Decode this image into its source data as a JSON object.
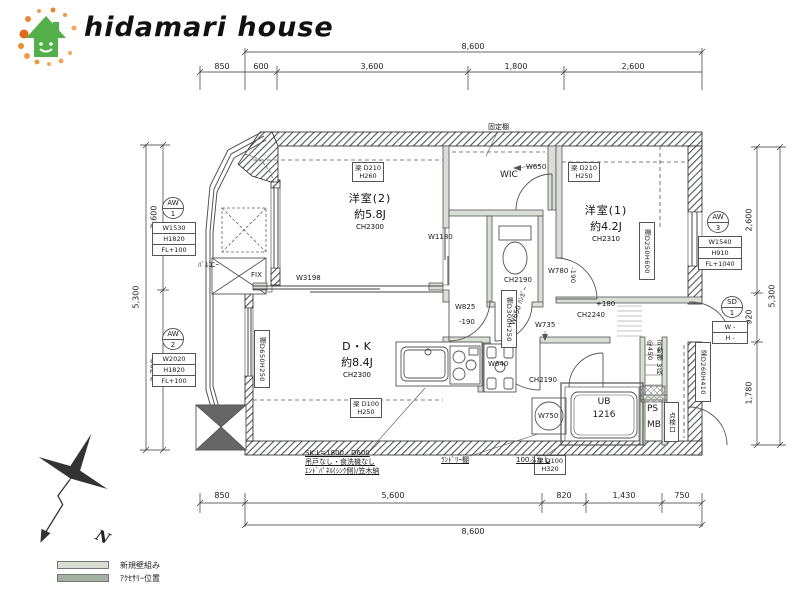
{
  "logo": {
    "text": "hidamari house"
  },
  "dims": {
    "top_total": "8,600",
    "top_segments": [
      "850",
      "600",
      "3,600",
      "1,800",
      "2,600"
    ],
    "bottom_segments": [
      "850",
      "5,600",
      "820",
      "1,430",
      "750"
    ],
    "bottom_total": "8,600",
    "left_total": "5,300",
    "left_segments": [
      "2,600",
      "2,700"
    ],
    "right_total": "5,300",
    "right_segments": [
      "2,600",
      "920",
      "1,780"
    ]
  },
  "rooms": {
    "yoshitsu2": {
      "name": "洋室(2)",
      "size": "約5.8J",
      "ch": "CH2300"
    },
    "yoshitsu1": {
      "name": "洋室(1)",
      "size": "約4.2J",
      "ch": "CH2310"
    },
    "dk": {
      "name": "D・K",
      "size": "約8.4J",
      "ch": "CH2300"
    },
    "wic": "WIC",
    "balcony": "ﾊﾞﾙｺﾆｰ",
    "ub": {
      "line1": "UB",
      "line2": "1216"
    },
    "ps": "PS",
    "mb": "MB"
  },
  "tags": {
    "aw1": {
      "type": "AW",
      "num": "1",
      "rows": [
        "W1530",
        "H1820",
        "FL+100"
      ]
    },
    "aw2": {
      "type": "AW",
      "num": "2",
      "rows": [
        "W2020",
        "H1820",
        "FL+100"
      ]
    },
    "aw3": {
      "type": "AW",
      "num": "3",
      "rows": [
        "W1540",
        "H910",
        "FL+1040"
      ]
    },
    "sd1": {
      "type": "SD",
      "num": "1",
      "rows": [
        "W -",
        "H -"
      ]
    }
  },
  "beams": {
    "y2": {
      "l1": "梁 D210",
      "l2": "H260"
    },
    "y1": {
      "l1": "梁 D210",
      "l2": "H250"
    },
    "dk": {
      "l1": "梁 D100",
      "l2": "H250"
    },
    "south": {
      "l1": "梁 D100",
      "l2": "H320"
    },
    "east": "梁D260H410"
  },
  "shelves": {
    "dk_side": "棚D650H250",
    "hall": "棚D300H250",
    "y1_side": "棚D250H600",
    "fixed": "固定棚",
    "movable": "可動棚 3段 @450",
    "laundry": "ﾗﾝﾄﾞﾘｰ棚"
  },
  "annotations": {
    "fix": "FIX",
    "w3198": "W3198",
    "w1180": "W1180",
    "w650": "W650",
    "w780": "W780",
    "m190a": "-190",
    "m190b": "-190",
    "w825": "W825",
    "w650hanger": "W650 ﾊﾝｶﾞｰ",
    "w735": "W735",
    "ch2240": "CH2240",
    "p180": "+180",
    "ch2190_wc": "CH2190",
    "ch2190_sf": "CH2190",
    "w640": "W640",
    "w750": "W750",
    "tenkenko": "点検口",
    "fukashi": "100ふかし",
    "sk1": "SK:L=1800・D600",
    "sk2": "吊戸なし・食洗機なし",
    "sk3": "ｴﾝﾄﾞﾊﾟﾈﾙ(ｼﾝｸ側)/笠木納"
  },
  "compass": {
    "label": "N"
  },
  "legend": {
    "items": [
      {
        "label": "新規壁組み",
        "color": "#d9ddd4"
      },
      {
        "label": "ｱｸｾｻﾘｰ位置",
        "color": "#a3b0a3"
      }
    ]
  },
  "colors": {
    "logo_green": "#53b04a",
    "logo_orange": "#e8872e",
    "wall_hatch": "#52565a",
    "interior_wall": "#d9ded6"
  }
}
